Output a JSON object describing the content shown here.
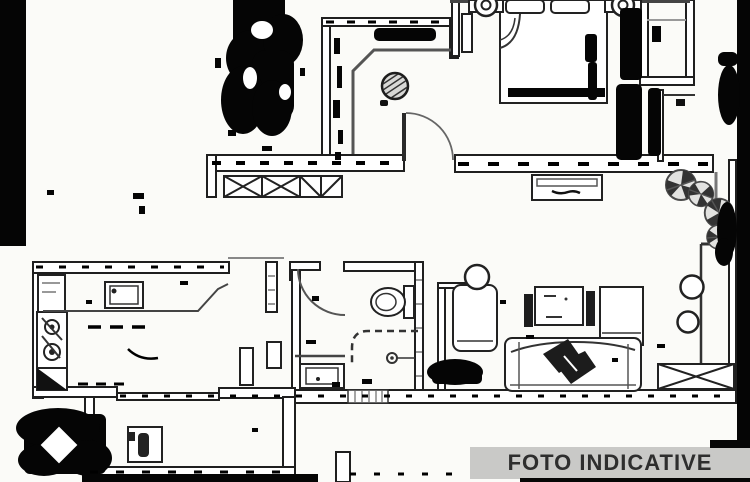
{
  "banner": {
    "label": "FOTO INDICATIVE",
    "bg_color": "#c9c9c7",
    "text_color": "#2e2e2e"
  },
  "plan": {
    "type": "apartment-floor-plan",
    "line_color": "#1f1f1f",
    "paper_color": "#fbfbf8",
    "artifact_color": "#050505",
    "symbols": [
      "double-bed",
      "pillows",
      "blanket-fold",
      "nightstand-lamps",
      "wardrobe",
      "hatched-plant-table",
      "door-swing-arc",
      "radiator-window-x",
      "corridor",
      "stove-burners",
      "kitchen-sink",
      "kitchen-counter",
      "corner-cabinet",
      "toilet",
      "shower-dashed-enclosure",
      "shower-drain",
      "vanity-sink",
      "threshold-stripes",
      "washing-machine",
      "sofa",
      "throw-blanket",
      "armchair",
      "round-side-table",
      "tv-cabinet",
      "tall-cabinet",
      "balcony-fan-plants",
      "round-stools",
      "window-x-box",
      "scan-smudges"
    ]
  }
}
